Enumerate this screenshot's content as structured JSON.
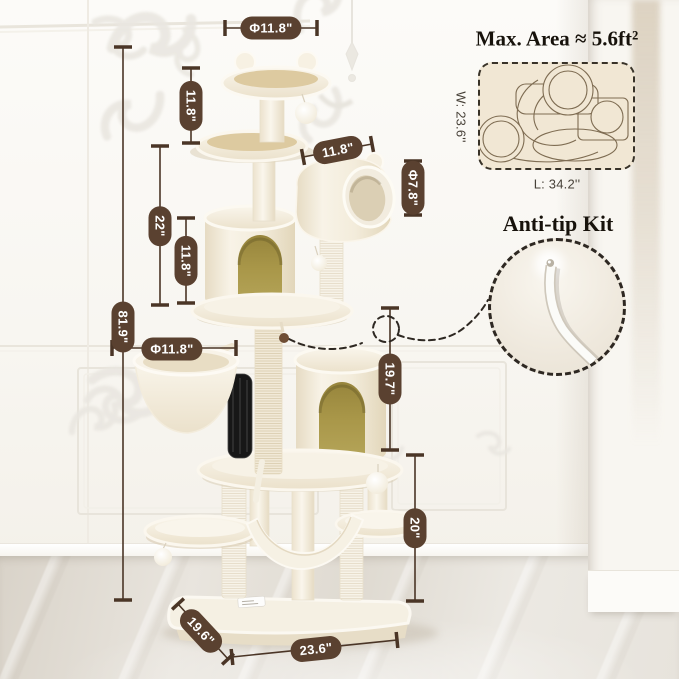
{
  "dimensions": {
    "top_perch_diameter": "Φ11.8\"",
    "top_section_height": "11.8\"",
    "middle_section_height": "22\"",
    "upper_condo_height": "11.8\"",
    "overall_height": "81.9\"",
    "tunnel_length": "11.8\"",
    "tunnel_diameter": "Φ7.8\"",
    "basket_diameter": "Φ11.8\"",
    "lower_section_height": "19.7\"",
    "bottom_section_height": "20\"",
    "base_depth": "19.6\"",
    "base_width": "23.6\""
  },
  "max_area": {
    "title": "Max. Area ≈ 5.6ft²",
    "width_label": "W: 23.6''",
    "length_label": "L: 34.2''"
  },
  "anti_tip": {
    "title": "Anti-tip Kit"
  },
  "colors": {
    "annotation_pill": "#5a4130",
    "annotation_line": "#4a3526",
    "plush_cream": "#f6f0e2",
    "platform_tan": "#ddcaa0",
    "arch_olive": "#a99749",
    "diagram_beige": "#f1e7d4",
    "wall_white": "#fbfaf6",
    "floor_marble": "#e5e1d9"
  }
}
